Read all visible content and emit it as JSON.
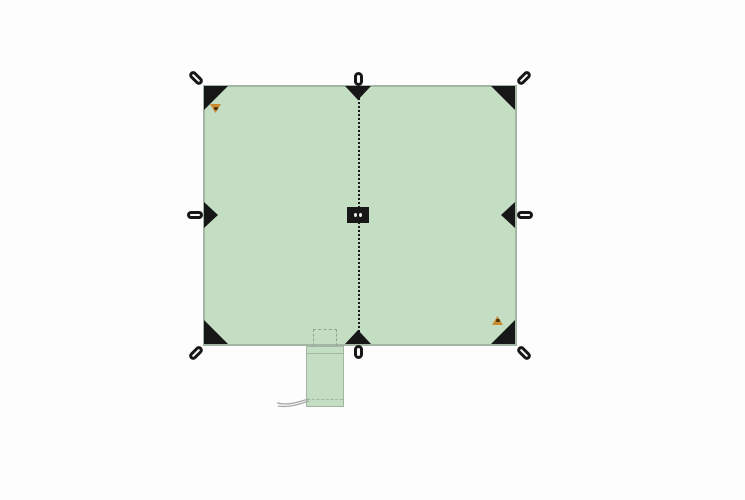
{
  "page": {
    "kind": "product-illustration",
    "subject": "square tarp top view with stuff sack"
  },
  "colors": {
    "bg": "#fdfdfd",
    "tarp-fill": "#c3dec3",
    "tarp-outline": "#a3b5a3",
    "hardware-black": "#171717",
    "patch-dot": "#eeeeee",
    "logo-orange": "#c98a2f",
    "logo-dark": "#553508",
    "pocket-dash": "#93a893",
    "cord-gray": "#a6aaa6"
  },
  "illustration": {
    "tarp": {
      "shape": "rectangle",
      "ridge": "vertical dotted center seam",
      "center_patch": "black reinforcement patch with two eyelets",
      "corner_attachments": 4,
      "mid_edge_attachments": 4,
      "loops_total": 8
    },
    "logos": {
      "top_left": "orange triangular brand logo",
      "bottom_right": "orange triangular brand logo"
    },
    "accessories": {
      "pocket": "dashed stuff-pocket outline at bottom edge",
      "stuff_sack": "matching green stuff sack with drawstring cord"
    }
  }
}
